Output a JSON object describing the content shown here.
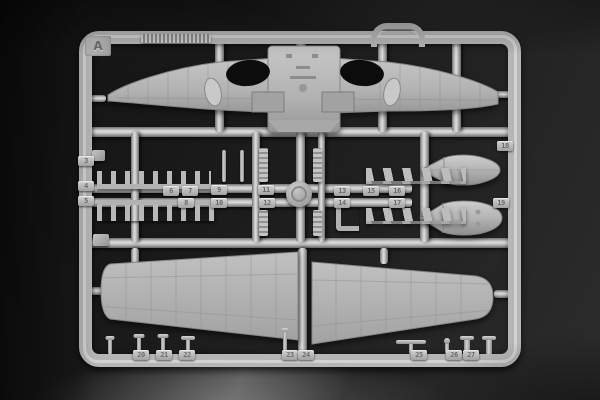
{
  "sprue": {
    "letter": "A",
    "tabs": [
      {
        "label": "3",
        "x": 86,
        "y": 161
      },
      {
        "label": "4",
        "x": 86,
        "y": 186
      },
      {
        "label": "5",
        "x": 86,
        "y": 201
      },
      {
        "label": "6",
        "x": 171,
        "y": 191
      },
      {
        "label": "7",
        "x": 190,
        "y": 191
      },
      {
        "label": "8",
        "x": 186,
        "y": 203
      },
      {
        "label": "9",
        "x": 219,
        "y": 190
      },
      {
        "label": "10",
        "x": 219,
        "y": 203
      },
      {
        "label": "11",
        "x": 266,
        "y": 190
      },
      {
        "label": "12",
        "x": 267,
        "y": 203
      },
      {
        "label": "13",
        "x": 342,
        "y": 191
      },
      {
        "label": "14",
        "x": 342,
        "y": 203
      },
      {
        "label": "15",
        "x": 371,
        "y": 191
      },
      {
        "label": "16",
        "x": 397,
        "y": 191
      },
      {
        "label": "17",
        "x": 397,
        "y": 203
      },
      {
        "label": "18",
        "x": 505,
        "y": 146
      },
      {
        "label": "19",
        "x": 501,
        "y": 203
      },
      {
        "label": "20",
        "x": 141,
        "y": 355
      },
      {
        "label": "21",
        "x": 164,
        "y": 355
      },
      {
        "label": "22",
        "x": 187,
        "y": 355
      },
      {
        "label": "23",
        "x": 290,
        "y": 355
      },
      {
        "label": "24",
        "x": 306,
        "y": 355
      },
      {
        "label": "25",
        "x": 419,
        "y": 355
      },
      {
        "label": "26",
        "x": 454,
        "y": 355
      },
      {
        "label": "27",
        "x": 471,
        "y": 355
      }
    ]
  },
  "colors": {
    "plastic": "#b6b6b6",
    "plastic_highlight": "#dedede",
    "plastic_shadow": "#6e6e6e",
    "background": "#1d1d1d",
    "nacelle_hole": "#0c0c0c"
  }
}
